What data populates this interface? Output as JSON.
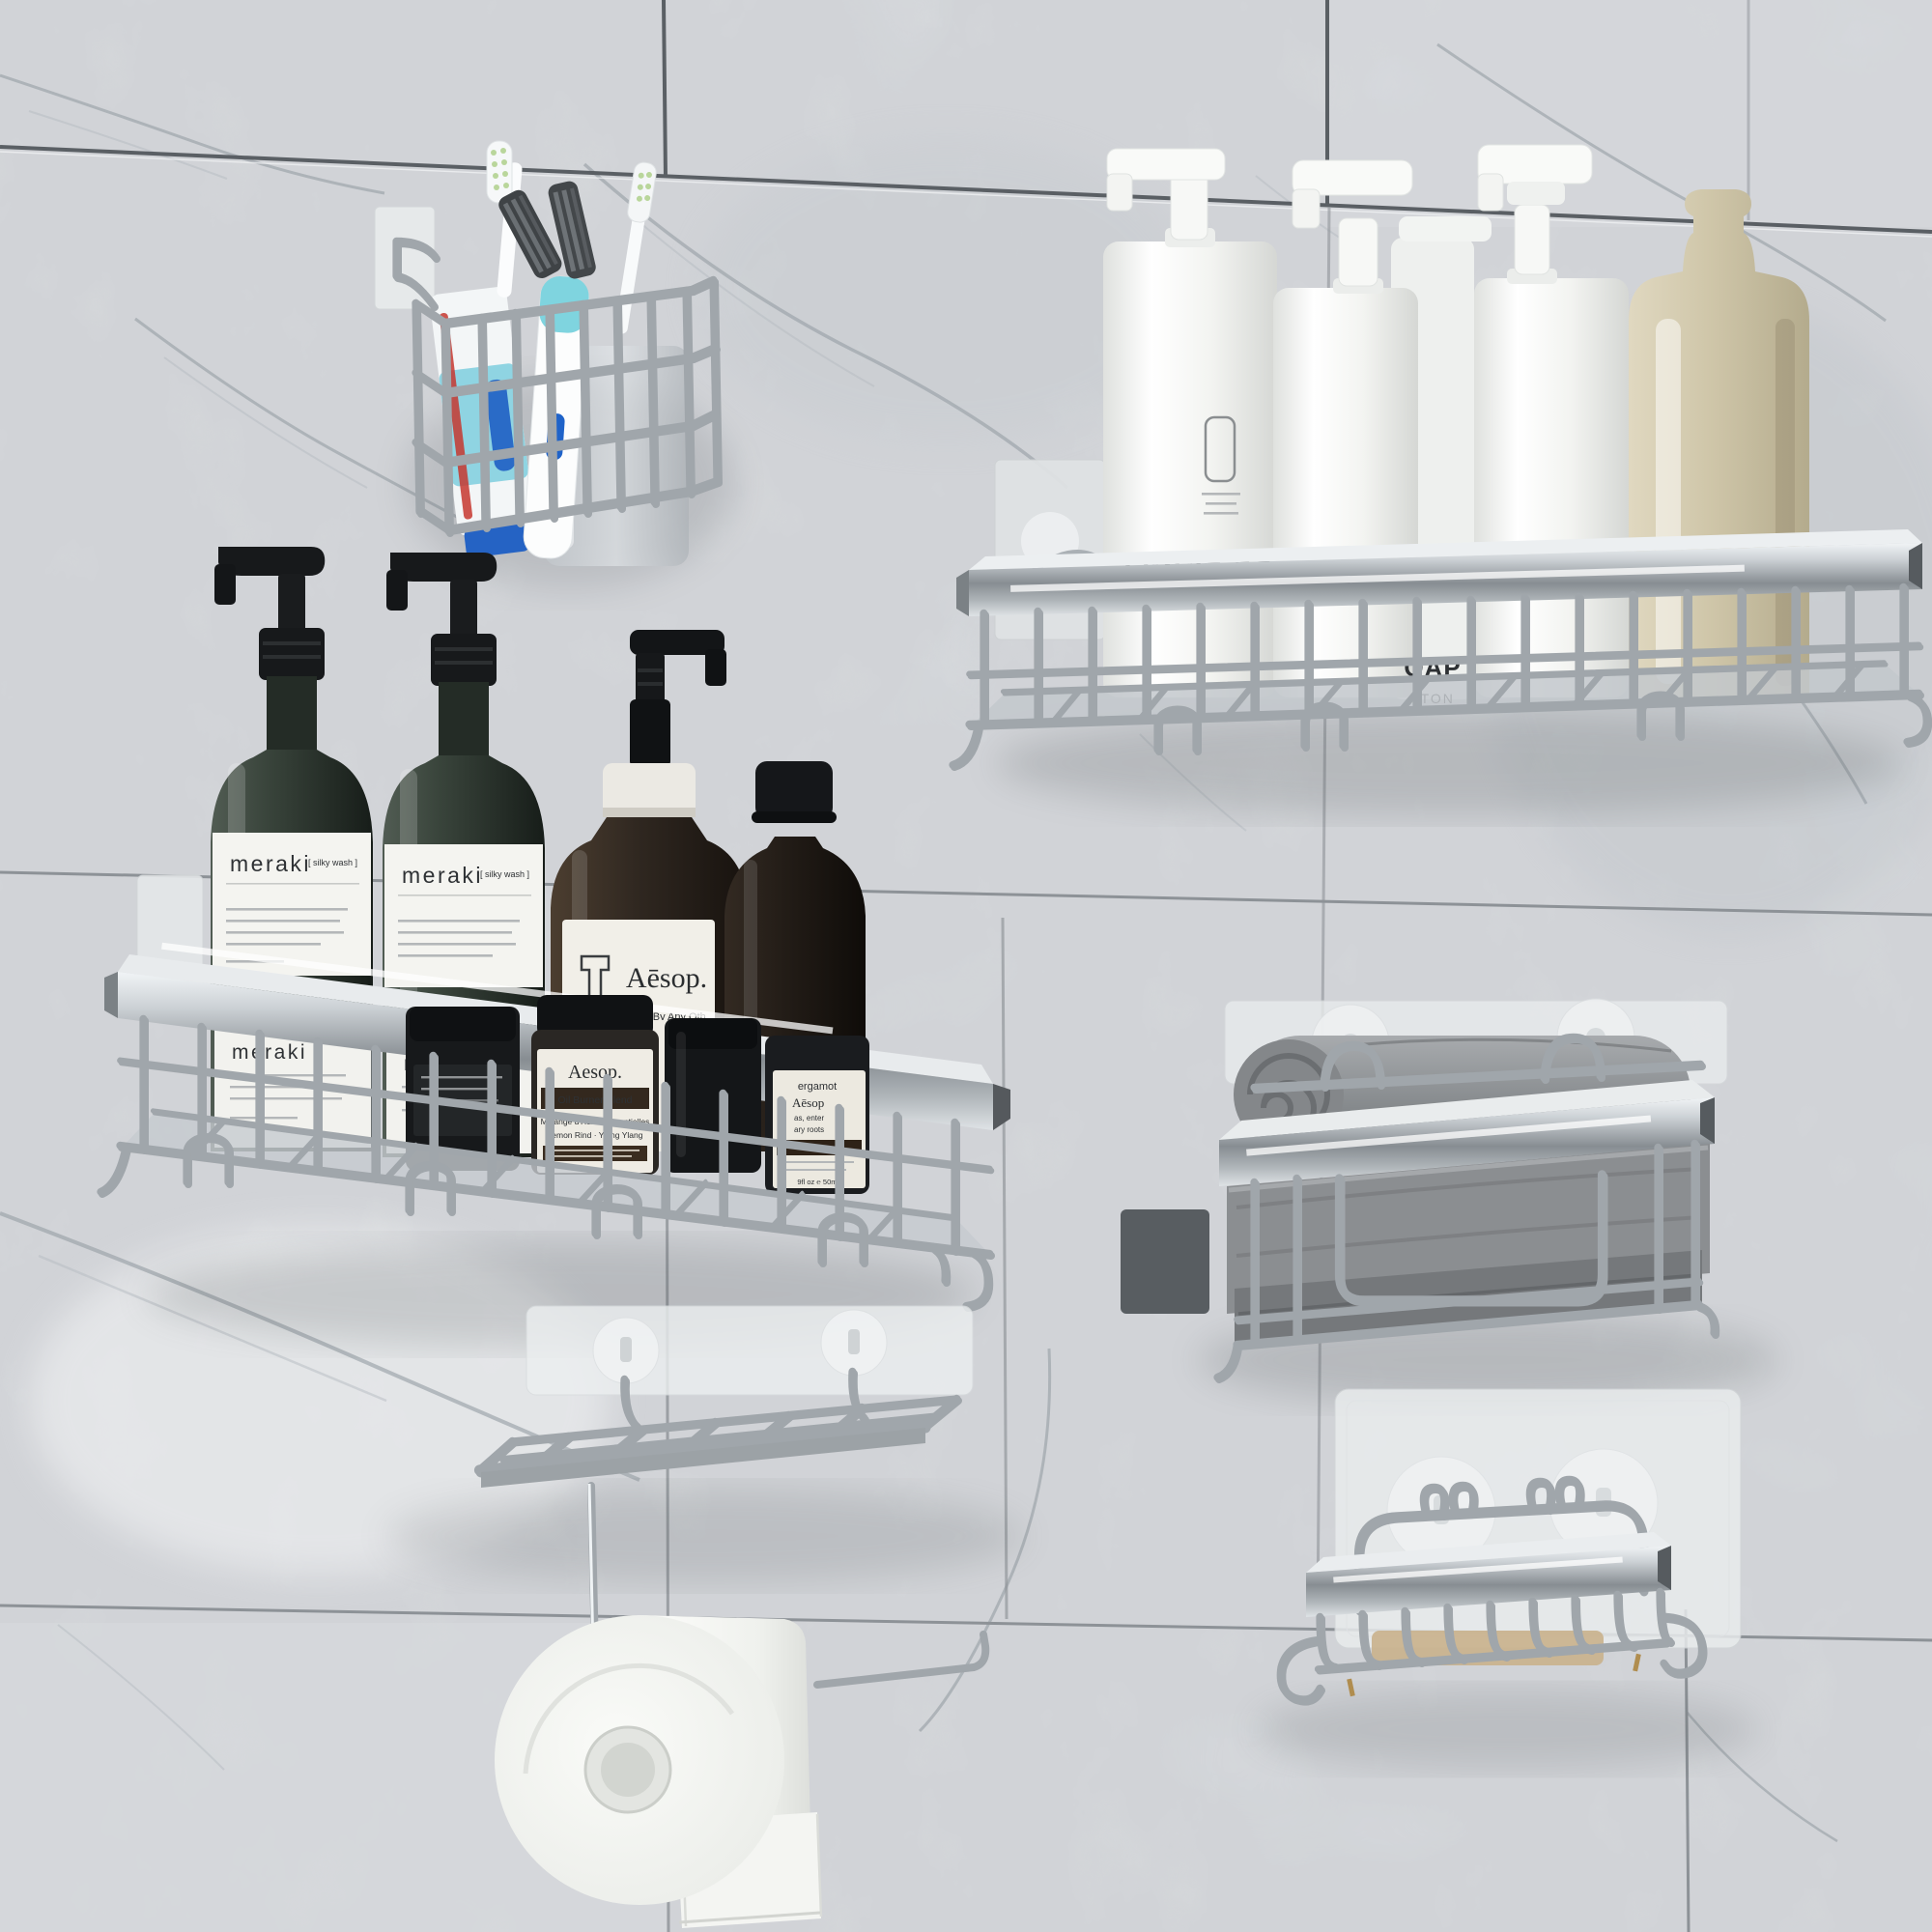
{
  "meta": {
    "type": "product-photo",
    "subject": "Six-piece adhesive chrome bathroom shower caddy organizer set mounted on a gray marble tile wall",
    "units": [
      "toothbrush-holder",
      "shampoo-basket-right",
      "shampoo-basket-left",
      "towel-basket",
      "toilet-paper-holder",
      "soap-dish"
    ]
  },
  "palette": {
    "wall": "#edeff1",
    "grout": "#53585d",
    "chrome": "#c6cbd0",
    "chrome_dark": "#6e7478",
    "towel_gray": "#8b8e91",
    "bottle_green": "#333d35",
    "bottle_amber": "#2f2621",
    "bottle_white": "#f6f7f5",
    "frosted_amber": "#cfc6a9",
    "paper_white": "#f4f5f2",
    "soap_tan": "#c9b18c"
  },
  "labels": {
    "white_bottle": {
      "brand": "LIQUID SOA",
      "variant": "NORDIC COTTON",
      "line2a": "ABSOLUTE",
      "line2b": "NORDI",
      "line2c": "SKINCARE"
    },
    "white_bottle_back": {
      "l1": "OAP",
      "l2": "TTON"
    },
    "meraki": {
      "brand": "meraki",
      "tag": "[ silky wash ]"
    },
    "aesop_bottle": {
      "brand": "Aēsop.",
      "sub": "A Rose By Any Oth"
    },
    "aesop_jar": {
      "brand": "Aesop.",
      "band": "Oil Burner Blend",
      "sub1": "Mélange d'Huiles Essentielles",
      "sub2": "Lemon Rind · Ylang Ylang"
    },
    "side_label": {
      "l1": "Rose Petal · Cardam",
      "l2": "Petale de Rose · Card"
    },
    "jar_right": {
      "l1": "ergamot",
      "l2": "Aēsop",
      "l3": "as, enter",
      "l4": "ary roots",
      "l5": "9fl oz ℮ 50mL"
    }
  }
}
